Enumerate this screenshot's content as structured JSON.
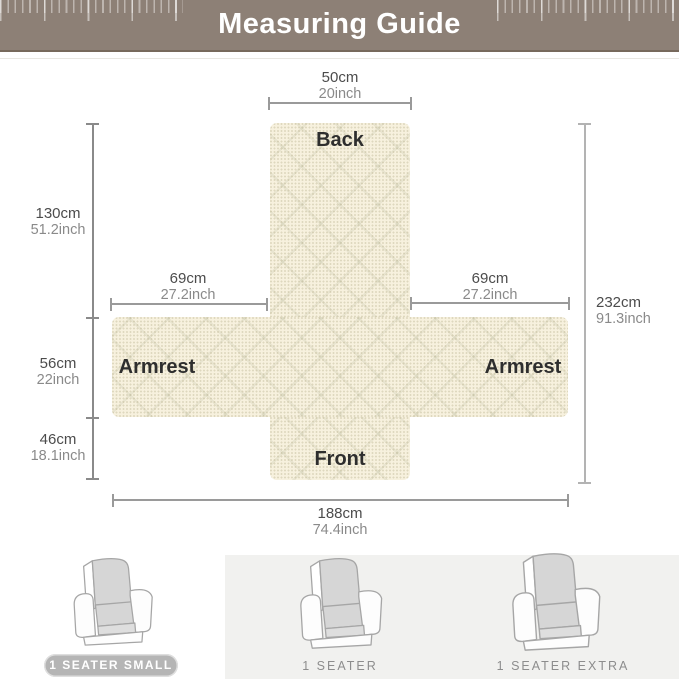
{
  "header": {
    "title": "Measuring Guide"
  },
  "diagram": {
    "labels": {
      "back": "Back",
      "front": "Front",
      "armrest_left": "Armrest",
      "armrest_right": "Armrest"
    },
    "measurements": {
      "top_width": {
        "cm": "50cm",
        "inch": "20inch"
      },
      "back_height": {
        "cm": "130cm",
        "inch": "51.2inch"
      },
      "left_armrest_width": {
        "cm": "69cm",
        "inch": "27.2inch"
      },
      "right_armrest_width": {
        "cm": "69cm",
        "inch": "27.2inch"
      },
      "total_height": {
        "cm": "232cm",
        "inch": "91.3inch"
      },
      "armrest_height": {
        "cm": "56cm",
        "inch": "22inch"
      },
      "front_height": {
        "cm": "46cm",
        "inch": "18.1inch"
      },
      "total_width": {
        "cm": "188cm",
        "inch": "74.4inch"
      }
    }
  },
  "size_options": [
    {
      "label": "1 SEATER SMALL",
      "selected": true
    },
    {
      "label": "1 SEATER",
      "selected": false
    },
    {
      "label": "1 SEATER EXTRA",
      "selected": false
    }
  ],
  "colors": {
    "header_bg": "#8d8076",
    "fabric": "#f7f1de",
    "dim_line": "#9a9a9a",
    "badge_bg": "#b5b5b5",
    "panel_bg": "#f1f1ef"
  }
}
